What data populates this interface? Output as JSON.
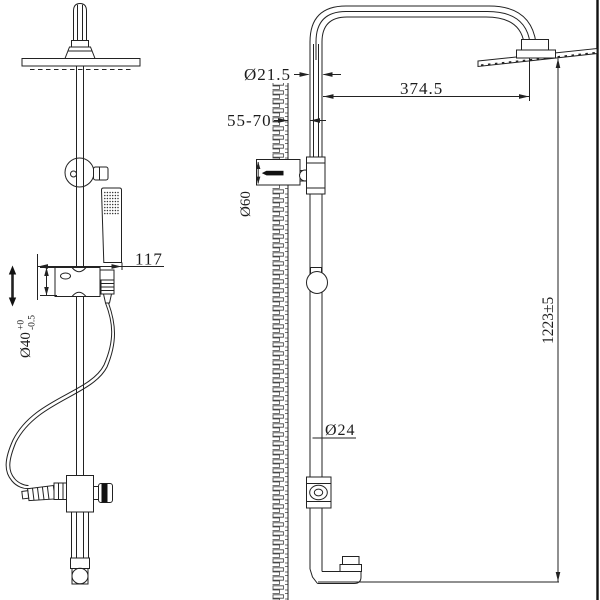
{
  "drawing": {
    "type": "technical-drawing",
    "subject": "shower column with overhead shower and hand shower, front and side views",
    "colors": {
      "line": "#222222",
      "background": "#ffffff",
      "solid": "#111111"
    }
  },
  "dims": {
    "head_pipe": {
      "label": "Ø21.5"
    },
    "reach": {
      "label": "374.5"
    },
    "wall_distance": {
      "label": "55-70"
    },
    "bracket": {
      "label": "Ø60"
    },
    "hand_offset": {
      "label": "117"
    },
    "slider": {
      "label": "Ø40",
      "tol_top": "+0",
      "tol_bottom": "-0.5"
    },
    "pipe": {
      "label": "Ø24"
    },
    "height": {
      "label": "1223±5"
    }
  }
}
